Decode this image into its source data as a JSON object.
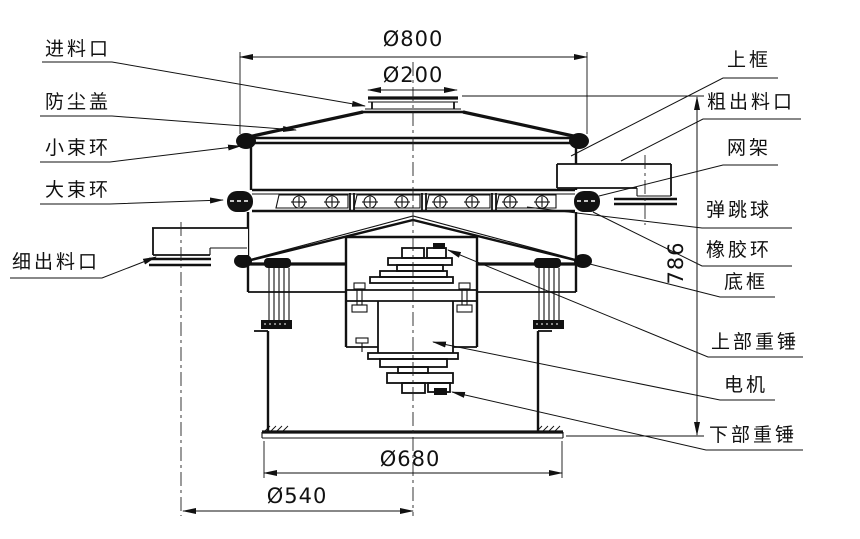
{
  "drawing": {
    "kind": "vibrating-sieve-section-drawing",
    "ink_color": "#111111",
    "background_color": "#ffffff"
  },
  "dimensions": {
    "inlet_diameter": "Ø200",
    "top_diameter": "Ø800",
    "overall_height": "786",
    "base_diameter": "Ø680",
    "stand_diameter": "Ø540"
  },
  "parts": {
    "left": [
      "进料口",
      "防尘盖",
      "小束环",
      "大束环",
      "细出料口"
    ],
    "right": [
      "上框",
      "粗出料口",
      "网架",
      "弹跳球",
      "橡胶环",
      "底框",
      "上部重锤",
      "电机",
      "下部重锤"
    ]
  }
}
